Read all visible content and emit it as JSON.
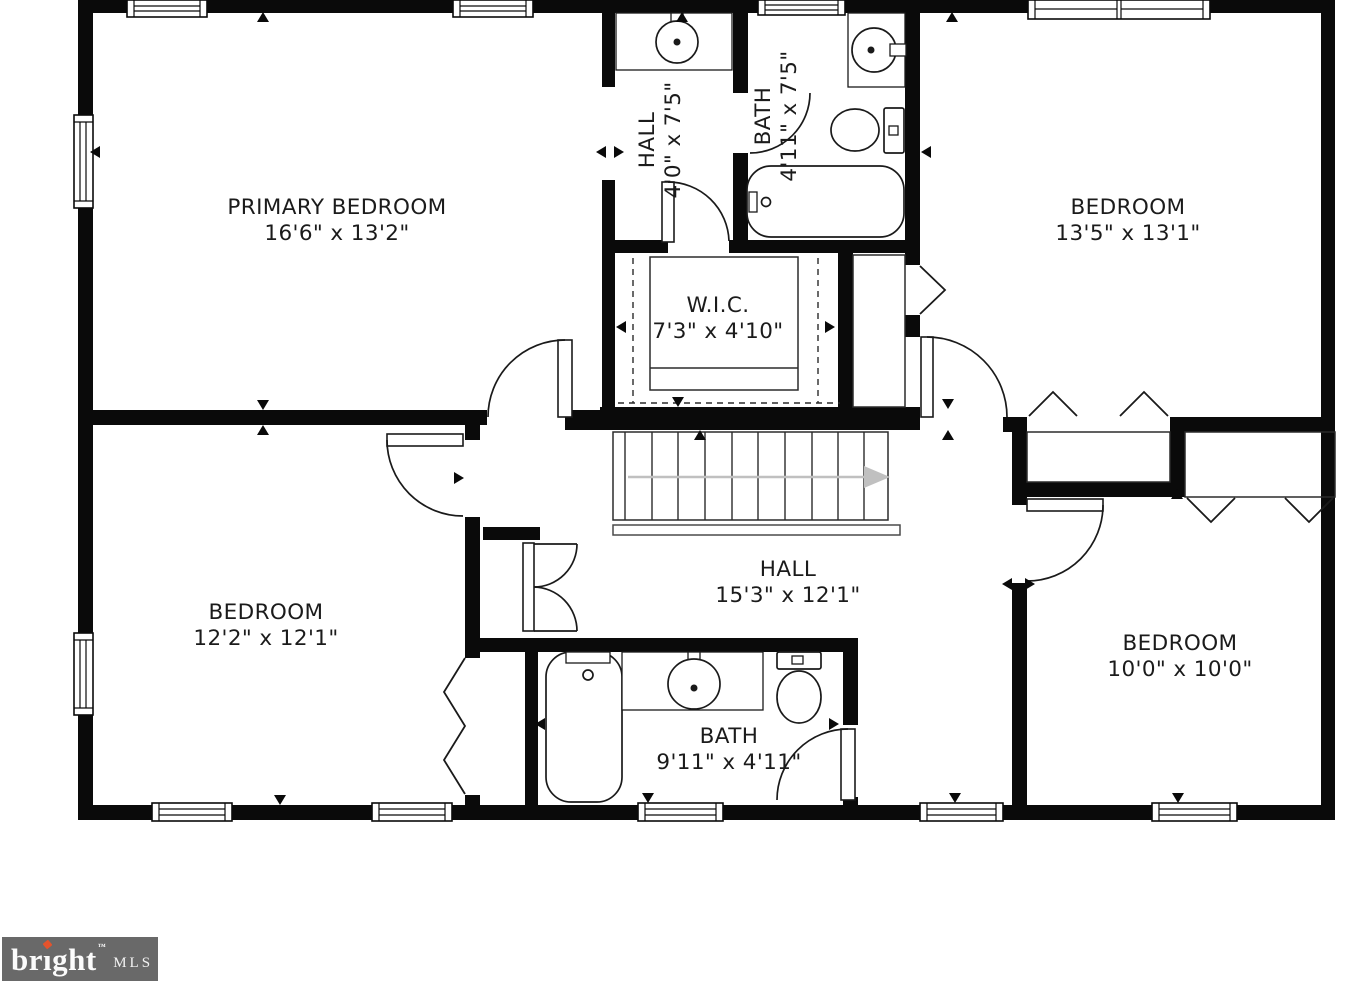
{
  "rooms": {
    "primary": {
      "name": "PRIMARY BEDROOM",
      "dims": "16'6\" x 13'2\""
    },
    "hall_upper": {
      "name": "HALL",
      "dims": "4'0\" x 7'5\""
    },
    "bath_upper": {
      "name": "BATH",
      "dims": "4'11\" x 7'5\""
    },
    "wic": {
      "name": "W.I.C.",
      "dims": "7'3\" x 4'10\""
    },
    "bedroom_top_right": {
      "name": "BEDROOM",
      "dims": "13'5\" x 13'1\""
    },
    "bedroom_bottom_left": {
      "name": "BEDROOM",
      "dims": "12'2\" x 12'1\""
    },
    "hall_main": {
      "name": "HALL",
      "dims": "15'3\" x 12'1\""
    },
    "bath_main": {
      "name": "BATH",
      "dims": "9'11\" x 4'11\""
    },
    "bedroom_bottom_right": {
      "name": "BEDROOM",
      "dims": "10'0\" x 10'0\""
    }
  },
  "stairs": {
    "treads": 11,
    "direction": "right"
  },
  "logo": {
    "brand_prefix": "br",
    "brand_i": "ı",
    "brand_rest": "ght",
    "trademark": "™",
    "mls": "MLS"
  },
  "colors": {
    "wall": "#0a0a0a",
    "stairs_arrow": "#c0c0c0",
    "logo_background": "#696969",
    "logo_accent": "#e4532c",
    "text": "#1b1b1b"
  }
}
